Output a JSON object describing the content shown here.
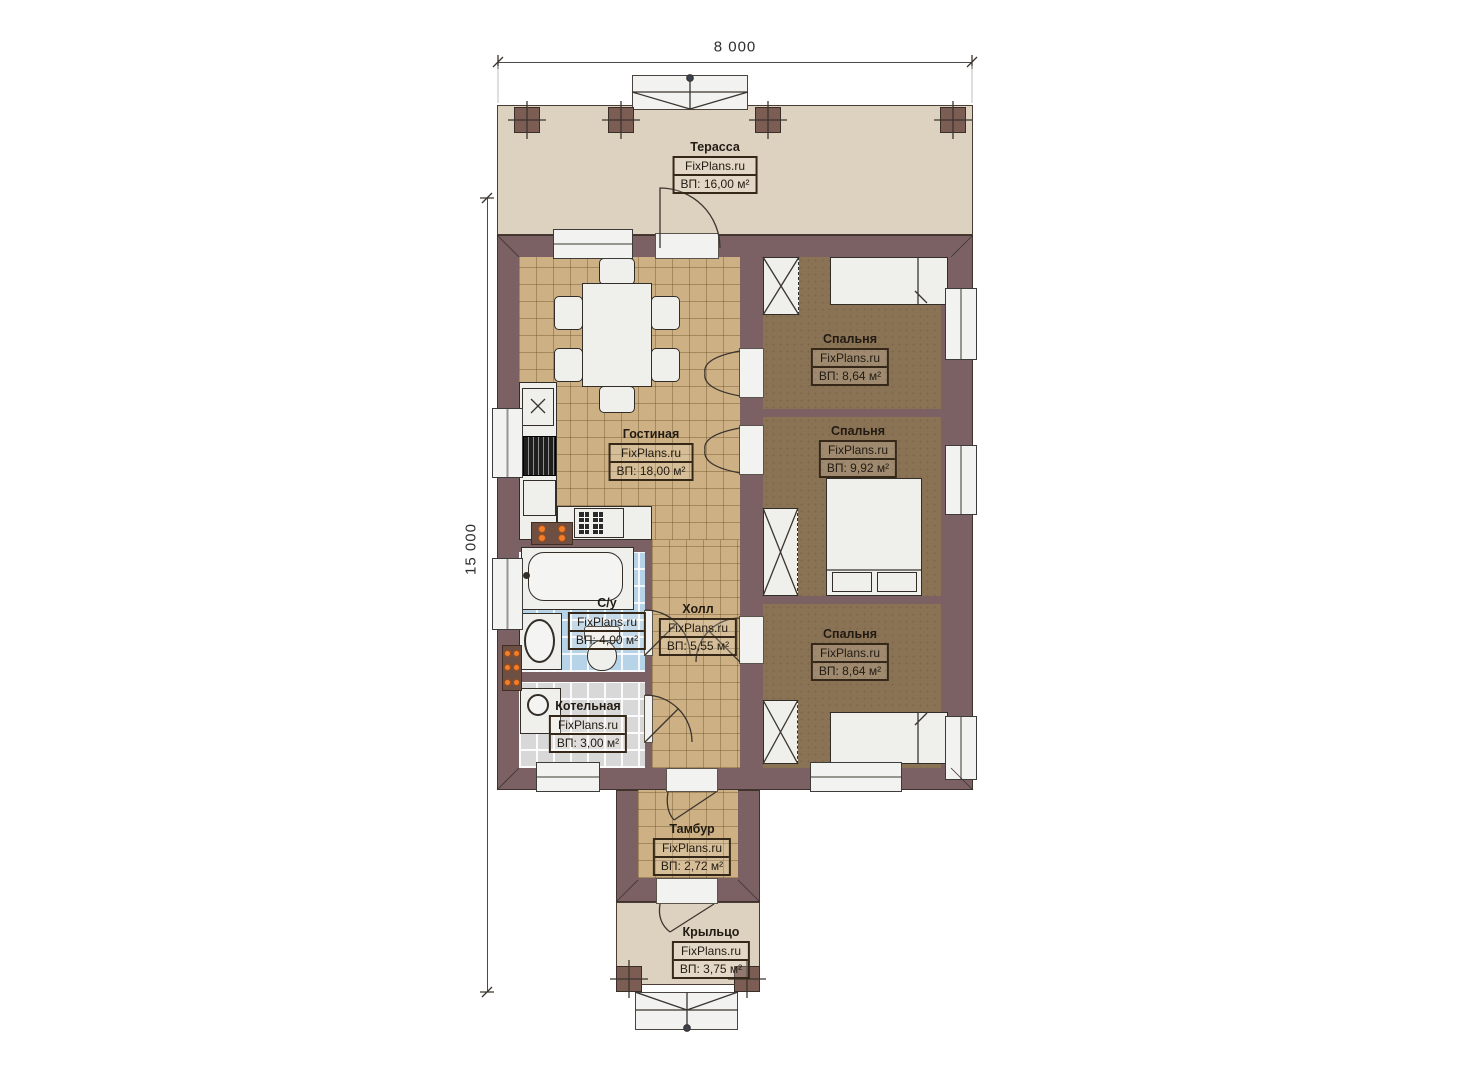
{
  "dimensions": {
    "width": "8 000",
    "height": "15 000"
  },
  "watermark": "FixPlans.ru",
  "rooms": [
    {
      "key": "terrace",
      "name": "Терасса",
      "area": "ВП: 16,00 м²"
    },
    {
      "key": "living",
      "name": "Гостиная",
      "area": "ВП: 18,00 м²"
    },
    {
      "key": "bedroom-top",
      "name": "Спальня",
      "area": "ВП: 8,64 м²"
    },
    {
      "key": "bedroom-middle",
      "name": "Спальня",
      "area": "ВП: 9,92 м²"
    },
    {
      "key": "bedroom-bottom",
      "name": "Спальня",
      "area": "ВП: 8,64 м²"
    },
    {
      "key": "bathroom",
      "name": "С/у",
      "area": "ВП: 4,00 м²"
    },
    {
      "key": "hall",
      "name": "Холл",
      "area": "ВП: 5,55 м²"
    },
    {
      "key": "boiler",
      "name": "Котельная",
      "area": "ВП: 3,00 м²"
    },
    {
      "key": "vestibule",
      "name": "Тамбур",
      "area": "ВП: 2,72 м²"
    },
    {
      "key": "porch",
      "name": "Крыльцо",
      "area": "ВП: 3,75 м²"
    }
  ],
  "colors": {
    "wall": "#7c6164",
    "terrace_floor": "#ddd1bf",
    "living_floor": "#cdb185",
    "bedroom_floor": "#8a7254",
    "bathroom_floor": "#b7d3e8",
    "boiler_floor": "#d8d8d8",
    "radiator_accent": "#f07e2d",
    "furniture": "#efefec"
  }
}
